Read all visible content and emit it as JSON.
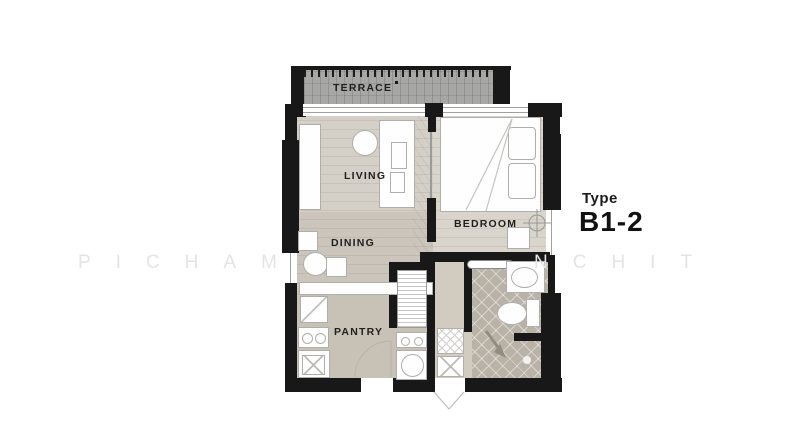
{
  "title": {
    "caption": "Type",
    "value": "B1-2"
  },
  "watermark": {
    "left": "PICHAM",
    "right": "NCHIT"
  },
  "rooms": {
    "terrace": "TERRACE",
    "living": "LIVING",
    "dining": "DINING",
    "bedroom": "BEDROOM",
    "pantry": "PANTRY"
  },
  "colors": {
    "wall": "#181818",
    "terrace_floor": "#a7a7a5",
    "living_floor": "#d5d0c7",
    "bedroom_floor": "#dad5cc",
    "pantry_floor": "#c8c2b6",
    "hall_floor": "#d1cbc0",
    "bathroom_floor": "#b9b2a7",
    "fixture_outline": "#b0aeaa",
    "label_text": "#1f1f1f",
    "watermark_text": "#e4e4e4"
  }
}
